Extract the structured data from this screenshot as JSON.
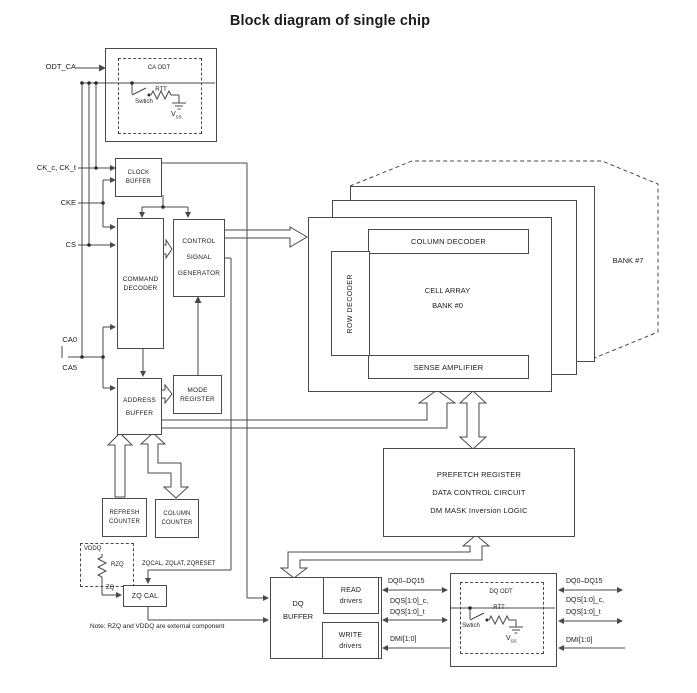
{
  "title": "Block diagram of single chip",
  "pins": {
    "odt_ca": "ODT_CA",
    "ck": "CK_c, CK_t",
    "cke": "CKE",
    "cs": "CS",
    "ca0": "CA0",
    "ca5": "CA5"
  },
  "ca_odt": {
    "label": "CA ODT",
    "rtt": "RTT",
    "switch": "Swtich",
    "vss_main": "V",
    "vss_sub": "SS"
  },
  "dq_odt": {
    "label": "DQ ODT",
    "rtt": "RTT",
    "switch": "Swtich",
    "vss_main": "V",
    "vss_sub": "SS"
  },
  "blocks": {
    "clock_buffer": [
      "CLOCK",
      "BUFFER"
    ],
    "command_decoder": [
      "COMMAND",
      "DECODER"
    ],
    "csg": [
      "CONTROL",
      "SIGNAL",
      "GENERATOR"
    ],
    "address_buffer": [
      "ADDRESS",
      "BUFFER"
    ],
    "mode_register": [
      "MODE",
      "REGISTER"
    ],
    "refresh_counter": [
      "REFRESH",
      "COUNTER"
    ],
    "column_counter": [
      "COLUMN",
      "COUNTER"
    ],
    "zq_cal": "ZQ CAL",
    "dq_buffer": [
      "DQ",
      "BUFFER"
    ],
    "read_drivers": [
      "READ",
      "drivers"
    ],
    "write_drivers": [
      "WRITE",
      "drivers"
    ],
    "prefetch": [
      "PREFETCH REGISTER",
      "DATA CONTROL CIRCUIT",
      "DM MASK Inversion LOGIC"
    ]
  },
  "bank": {
    "column_decoder": "COLUMN DECODER",
    "row_decoder": "ROW DECODER",
    "cell_array_1": "CELL ARRAY",
    "cell_array_2": "BANK #0",
    "sense_amplifier": "SENSE AMPLIFIER",
    "bank7": "BANK #7"
  },
  "zq": {
    "vddq": "VDDQ",
    "rzq": "RZQ",
    "zq": "ZQ",
    "signals": "ZQCAL, ZQLAT, ZQRESET",
    "note": "Note: RZQ and VDDQ are external component"
  },
  "signals": {
    "dq": "DQ0–DQ15",
    "dqs_c": "DQS[1:0]_c,",
    "dqs_t": "DQS[1:0]_t",
    "dmi": "DMI[1:0]"
  }
}
